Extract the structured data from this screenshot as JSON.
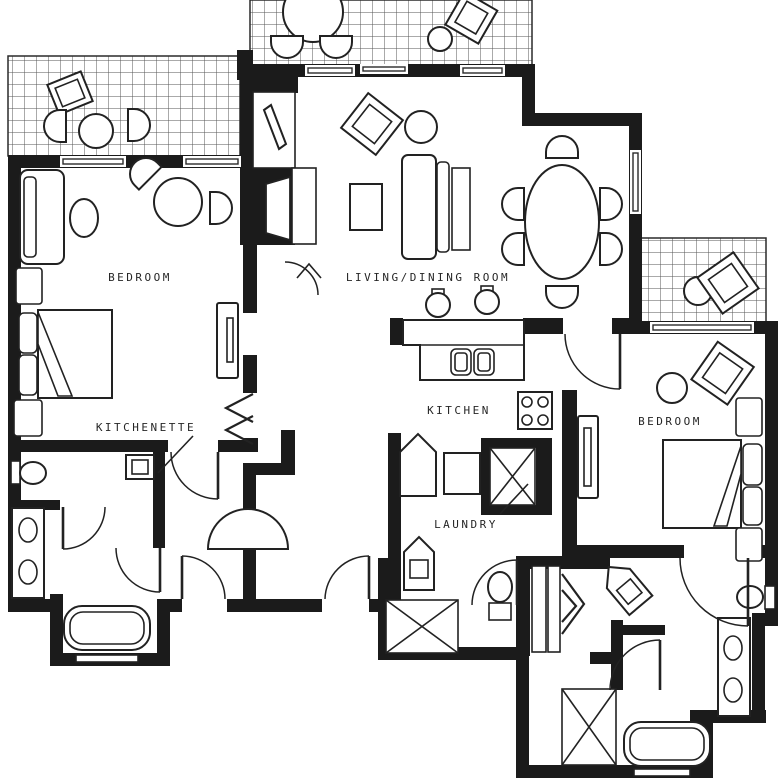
{
  "floor_plan": {
    "type": "architectural-floor-plan",
    "colors": {
      "background": "#ffffff",
      "walls": "#1b1b1b",
      "lines": "#222222",
      "hatch": "#555555"
    },
    "labels": {
      "bedroom_left": "BEDROOM",
      "living_dining_room": "LIVING/DINING ROOM",
      "kitchenette": "KITCHENETTE",
      "kitchen": "KITCHEN",
      "laundry": "LAUNDRY",
      "bedroom_right": "BEDROOM"
    }
  }
}
